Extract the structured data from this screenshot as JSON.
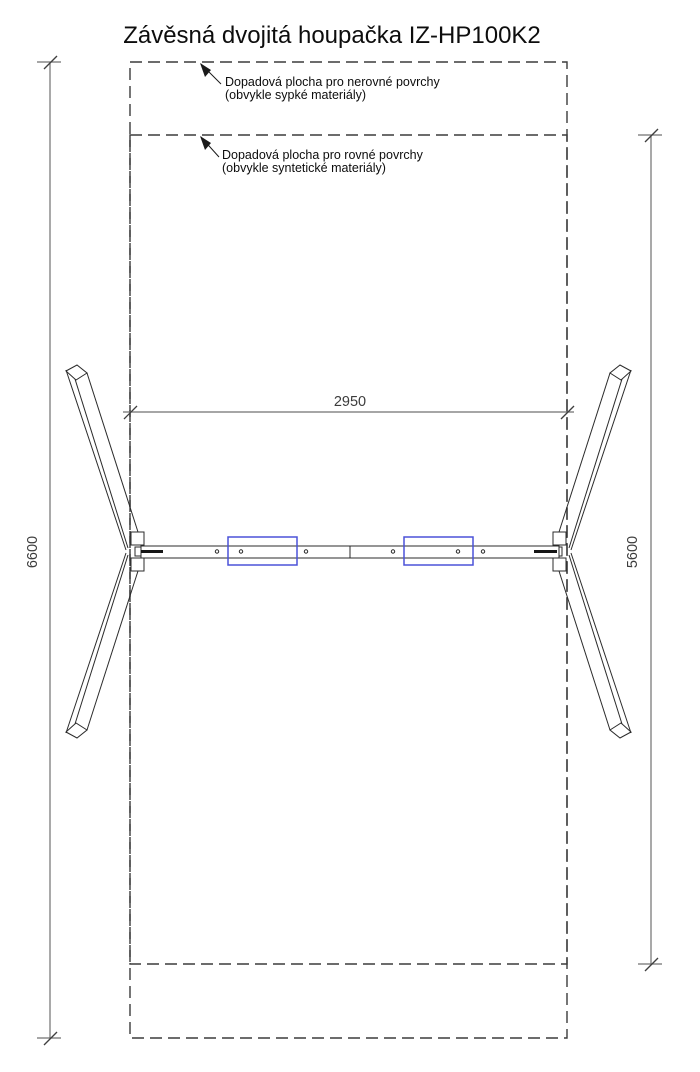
{
  "sheet": {
    "title": "Závěsná dvojitá houpačka IZ-HP100K2"
  },
  "fall_zones": {
    "uneven": {
      "label": "Dopadová plocha pro nerovné povrchy",
      "sublabel": "(obvykle sypké materiály)"
    },
    "even": {
      "label": "Dopadová plocha pro rovné povrchy",
      "sublabel": "(obvykle syntetické materiály)"
    }
  },
  "dimensions": {
    "total_height_mm": "6600",
    "inner_height_mm": "5600",
    "beam_span_mm": "2950"
  },
  "colors": {
    "seat_marker": "#4b52d8",
    "drawing_line": "#2b2b2b",
    "dimension_line": "#707070",
    "zone_dash": "#3b3b3b",
    "text": "#0d0d0d"
  }
}
